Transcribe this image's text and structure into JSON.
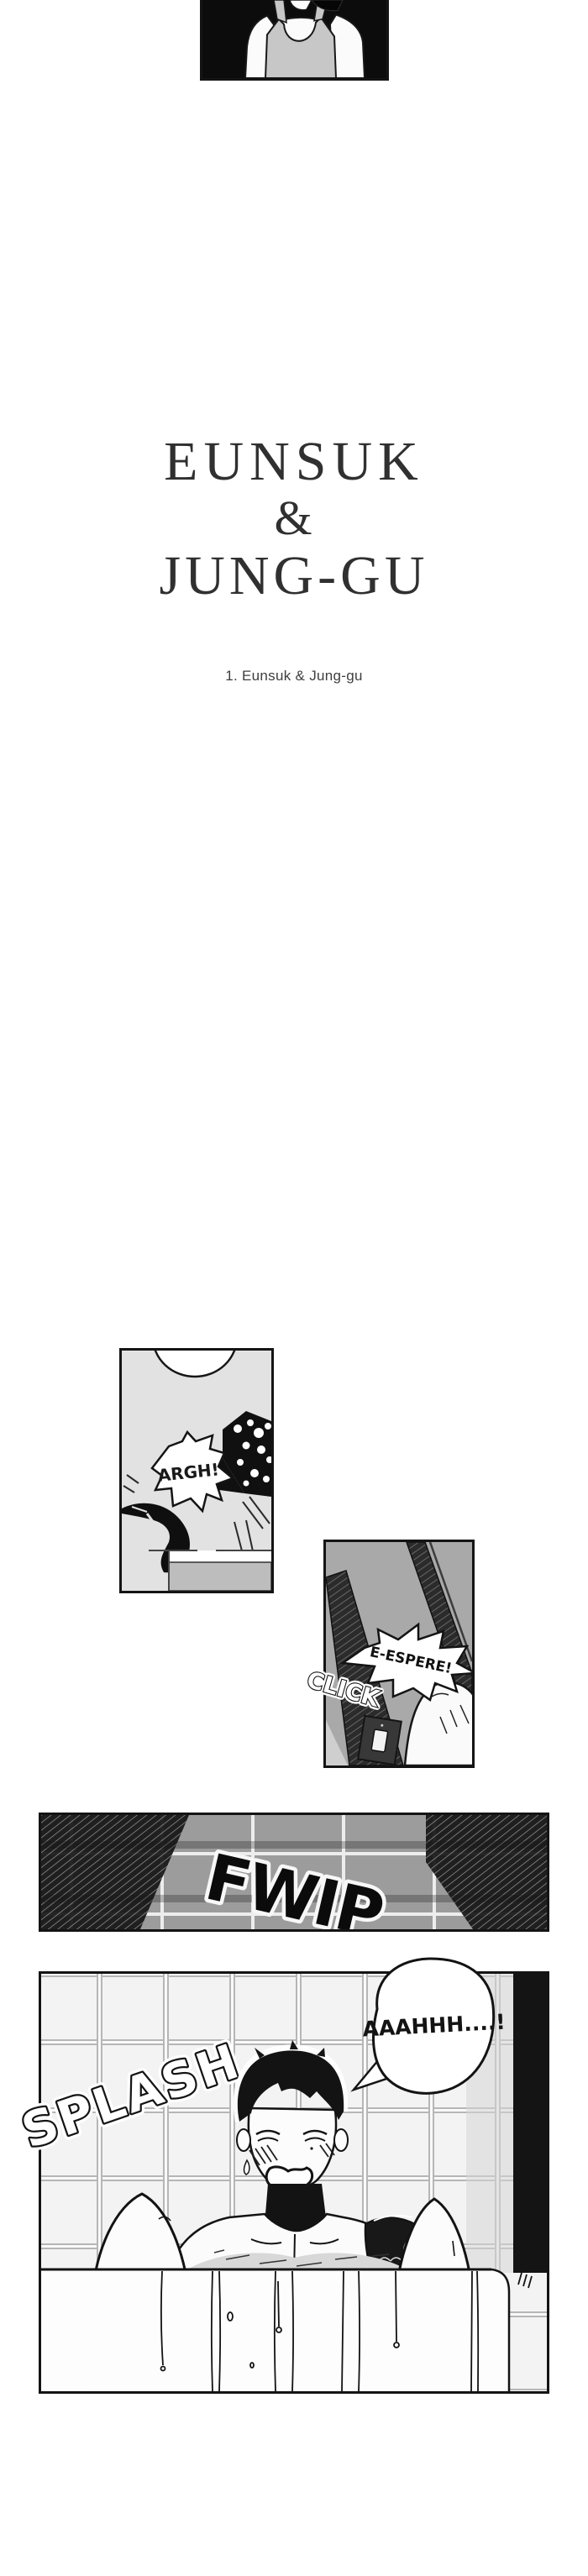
{
  "title": {
    "line1": "EUNSUK",
    "ampersand": "&",
    "line2": "JUNG-GU",
    "color": "#303030"
  },
  "chapter": {
    "label": "1. Eunsuk & Jung-gu",
    "color": "#3e3e3e"
  },
  "sfx": {
    "argh": "ARGH!",
    "click": "CLICK",
    "espere": "E-ESPERE!",
    "fwip": "FWIP",
    "splash": "SPLASH",
    "scream": "AAAHHH....!"
  },
  "colors": {
    "paper": "#ffffff",
    "ink": "#141414",
    "panel_argh_bg": "#e2e2e2",
    "panel_espere_bg": "#a9a9a9",
    "fwip_tile": "#9c9c9c",
    "bath_tile": "#f3f3f3",
    "skin": "#fbfbfb",
    "tank_top": "#c7c7c7"
  }
}
